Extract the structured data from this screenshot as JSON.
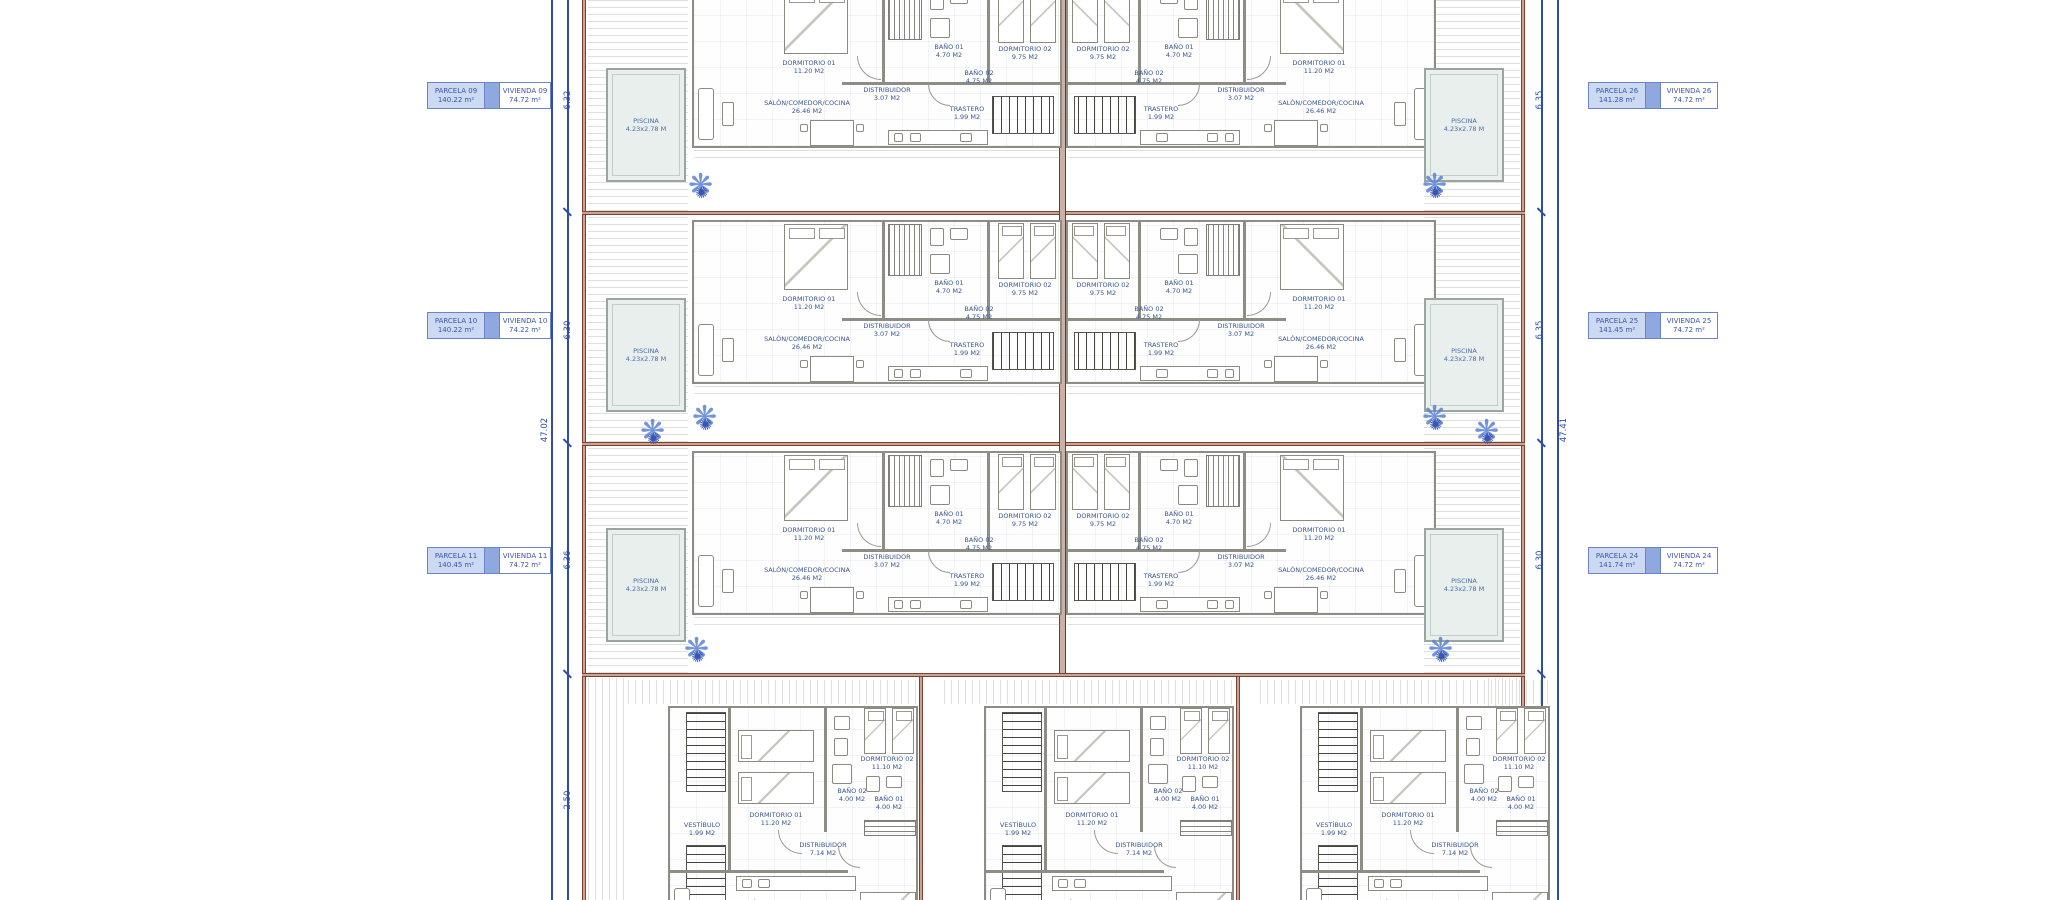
{
  "drawing": {
    "type": "architectural site / floor plan",
    "colors": {
      "boundary_red": "#82402f",
      "dimension_blue": "#2f4da8",
      "room_label_blue": "#39558f",
      "parcel_fill": "#ccd9f2",
      "parcel_connector": "#8fa8e0",
      "pool_fill": "#e9efed",
      "wall_gray": "#8d8d85",
      "palm_blue": "#5b82d6"
    }
  },
  "parcel_labels": {
    "left": [
      {
        "parcela": "PARCELA 09",
        "parcela_area": "140.22 m²",
        "vivienda": "VIVIENDA 09",
        "vivienda_area": "74.72 m²"
      },
      {
        "parcela": "PARCELA 10",
        "parcela_area": "140.22 m²",
        "vivienda": "VIVIENDA 10",
        "vivienda_area": "74.22 m²"
      },
      {
        "parcela": "PARCELA 11",
        "parcela_area": "140.45 m²",
        "vivienda": "VIVIENDA 11",
        "vivienda_area": "74.72 m²"
      }
    ],
    "right": [
      {
        "parcela": "PARCELA 26",
        "parcela_area": "141.28 m²",
        "vivienda": "VIVIENDA 26",
        "vivienda_area": "74.72 m²"
      },
      {
        "parcela": "PARCELA 25",
        "parcela_area": "141.45 m²",
        "vivienda": "VIVIENDA 25",
        "vivienda_area": "74.72 m²"
      },
      {
        "parcela": "PARCELA 24",
        "parcela_area": "141.74 m²",
        "vivienda": "VIVIENDA 24",
        "vivienda_area": "74.72 m²"
      }
    ]
  },
  "rooms_upper": {
    "dorm1": "DORMITORIO 01",
    "dorm1_area": "11.20 M2",
    "dorm2": "DORMITORIO 02",
    "dorm2_area": "9.75 M2",
    "bath1": "BAÑO 01",
    "bath1_area": "4.70 M2",
    "bath2": "BAÑO 02",
    "bath2_area": "4.75 M2",
    "distrib": "DISTRIBUIDOR",
    "distrib_area": "3.07 M2",
    "salon": "SALÓN/COMEDOR/COCINA",
    "salon_area": "26.46 M2",
    "trastero": "TRASTERO",
    "trastero_area": "1.99 M2"
  },
  "rooms_lower": {
    "dorm1": "DORMITORIO 01",
    "dorm1_area": "11.20 M2",
    "dorm2": "DORMITORIO 02",
    "dorm2_area": "11.10 M2",
    "bath1": "BAÑO 01",
    "bath1_area": "4.00 M2",
    "bath2": "BAÑO 02",
    "bath2_area": "4.00 M2",
    "distrib": "DISTRIBUIDOR",
    "distrib_area": "7.14 M2",
    "salon": "SALÓN/COMEDOR/COCINA",
    "salon_area": "20.27 M2",
    "vestibulo": "VESTÍBULO",
    "vestibulo_area": "1.99 M2"
  },
  "pool": {
    "name": "PISCINA",
    "size": "4.23x2.78 M"
  },
  "dimensions": {
    "left_total": "47.02",
    "left_segments": [
      "6.32",
      "6.30",
      "6.36",
      "2.50"
    ],
    "right_total": "47.41",
    "right_segments": [
      "6.35",
      "6.35",
      "6.30",
      "4.18"
    ]
  }
}
